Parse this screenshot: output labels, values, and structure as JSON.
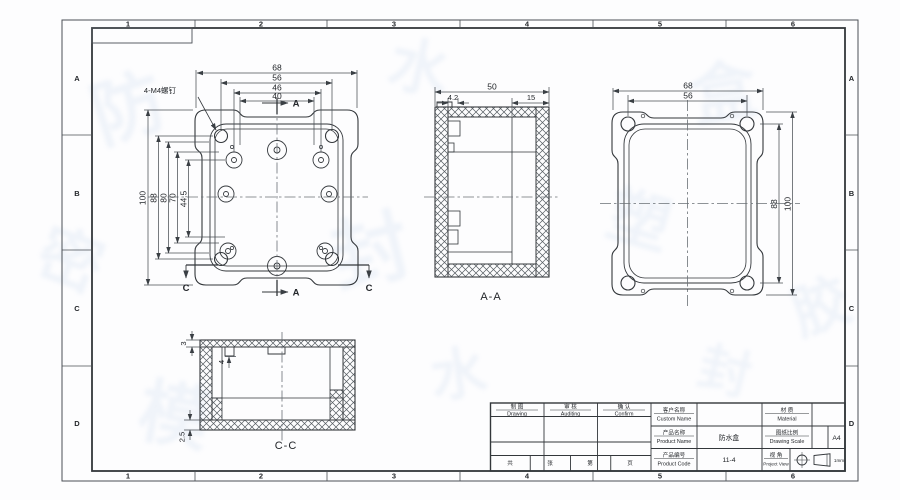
{
  "frame": {
    "zone_cols": [
      "1",
      "2",
      "3",
      "4",
      "5",
      "6"
    ],
    "zone_rows": [
      "A",
      "B",
      "C",
      "D"
    ]
  },
  "front_view": {
    "callout": "4-M4螺钉",
    "dims_top": [
      "68",
      "56",
      "46",
      "40"
    ],
    "dims_left": [
      "100",
      "88",
      "80",
      "70",
      "44.5"
    ],
    "section_a_top": "A",
    "section_a_bottom": "A",
    "section_c_left": "C",
    "section_c_right": "C"
  },
  "section_aa": {
    "label": "A-A",
    "dim_width": "50",
    "dim_left": "4.2",
    "dim_right": "15"
  },
  "back_view": {
    "dims_top": [
      "68",
      "56"
    ],
    "dims_right": [
      "88",
      "100"
    ]
  },
  "section_cc": {
    "label": "C-C",
    "dim_wall": "3",
    "dim_step": "4",
    "dim_bottom": "2.5"
  },
  "title_block": {
    "sign_columns": [
      {
        "zh": "制 图",
        "en": "Drawing"
      },
      {
        "zh": "审 核",
        "en": "Auditing"
      },
      {
        "zh": "确 认",
        "en": "Confirm"
      }
    ],
    "fields": {
      "customer": {
        "zh": "客户名称",
        "en": "Custom Name",
        "value": ""
      },
      "product_name": {
        "zh": "产品名称",
        "en": "Product Name",
        "value": "防水盒"
      },
      "product_code": {
        "zh": "产品编号",
        "en": "Product Code",
        "value": "11-4"
      },
      "material": {
        "zh": "材 质",
        "en": "Material",
        "value": ""
      },
      "scale": {
        "zh": "图纸比例",
        "en": "Drawing Scale",
        "value": ""
      },
      "view_angle": {
        "zh": "视 角",
        "en": "Project View",
        "value": ""
      }
    },
    "paper_size": "A4",
    "unit_note": "1mm",
    "page_row": [
      "共",
      "张",
      "第",
      "页"
    ]
  },
  "watermark": {
    "chars": [
      "防",
      "水",
      "盒",
      "密",
      "封",
      "塑",
      "胶",
      "模"
    ]
  }
}
